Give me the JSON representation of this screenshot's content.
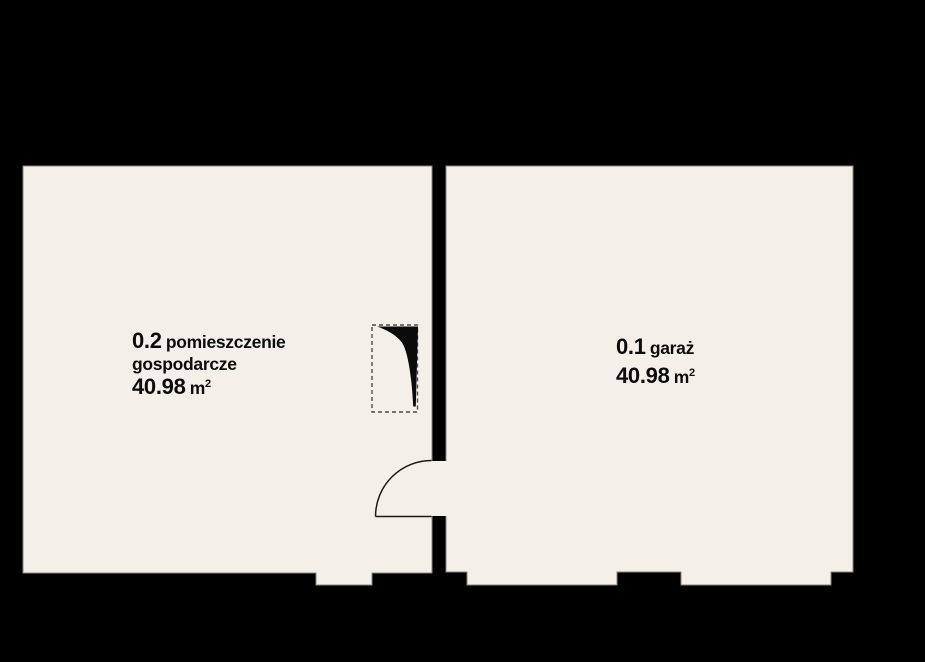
{
  "plan": {
    "background_color": "#000000",
    "floor_color": "#f4efe9",
    "outline_color": "#8a857d",
    "line_color": "#1a1a1a",
    "rooms": [
      {
        "number": "0.2",
        "name": "pomieszczenie gospodarcze",
        "area_value": "40.98",
        "area_unit": "m",
        "area_exponent": "2"
      },
      {
        "number": "0.1",
        "name": "garaż",
        "area_value": "40.98",
        "area_unit": "m",
        "area_exponent": "2"
      }
    ],
    "symbols": {
      "door_swing": "door-swing-arc",
      "door_dashed": "dashed-door-leaf-symbol"
    }
  }
}
